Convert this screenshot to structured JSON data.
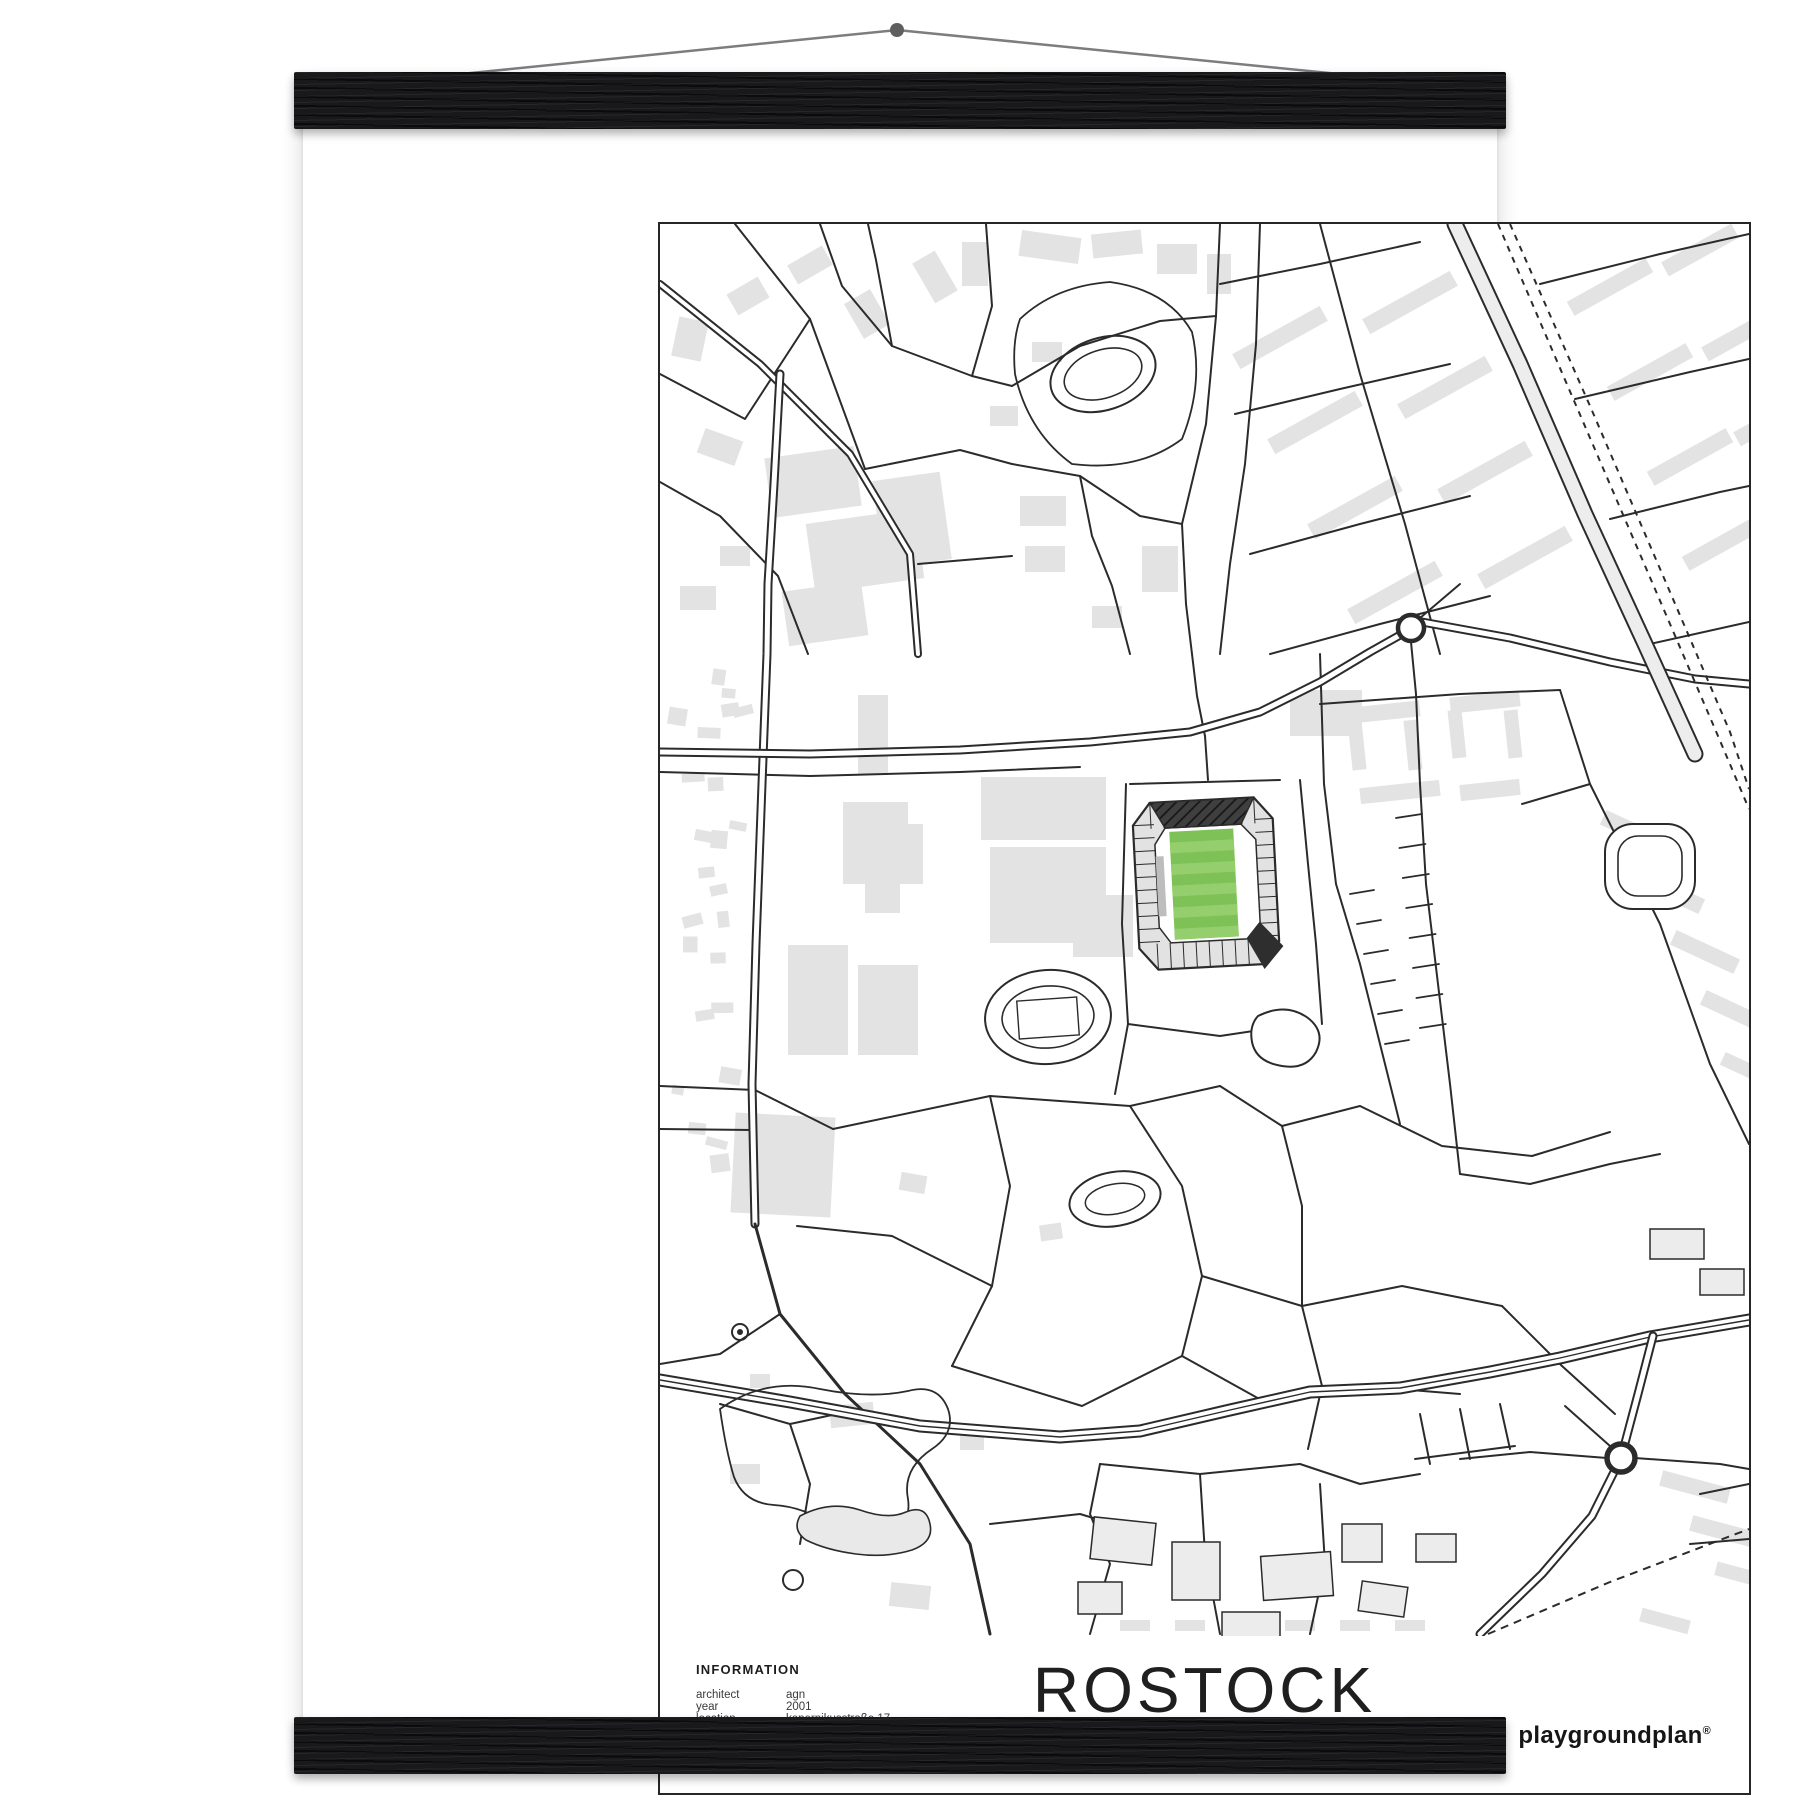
{
  "page": {
    "background": "#ffffff"
  },
  "hanger": {
    "bar_color": "#19191b",
    "string_color": "#7d7d7d",
    "nail_color": "#5f5f5f"
  },
  "poster": {
    "background": "#ffffff",
    "frame_color": "#262626"
  },
  "map": {
    "colors": {
      "street": "#2b2b2b",
      "building": "#e3e3e3",
      "building_light": "#ececec",
      "road_fill": "#ffffff",
      "avenue_fill": "#ededed",
      "pitch_green": "#7ec157",
      "pitch_stripe": "#94ce6d",
      "stand_gray": "#e2e2e2",
      "stand_dark": "#3f3f3f",
      "stand_wedge": "#2e2e2e",
      "stand_inner_strip": "#bdbdbd"
    }
  },
  "footer": {
    "info_title": "INFORMATION",
    "info_rows": [
      {
        "label": "architect",
        "value": "agn"
      },
      {
        "label": "year",
        "value": "2001"
      },
      {
        "label": "location",
        "value": "kopernikusstraße 17"
      },
      {
        "label": "capacity",
        "value": "29 000 (25 000)"
      },
      {
        "label": "surface",
        "value": "natural turf"
      },
      {
        "label": "field size",
        "value": "105 m × 68 m"
      }
    ],
    "title": "ROSTOCK",
    "coordinates": "54° 5' 5.8'' N  12° 5' 42.6'' E",
    "brand": "playgroundplan",
    "brand_mark": "®"
  }
}
